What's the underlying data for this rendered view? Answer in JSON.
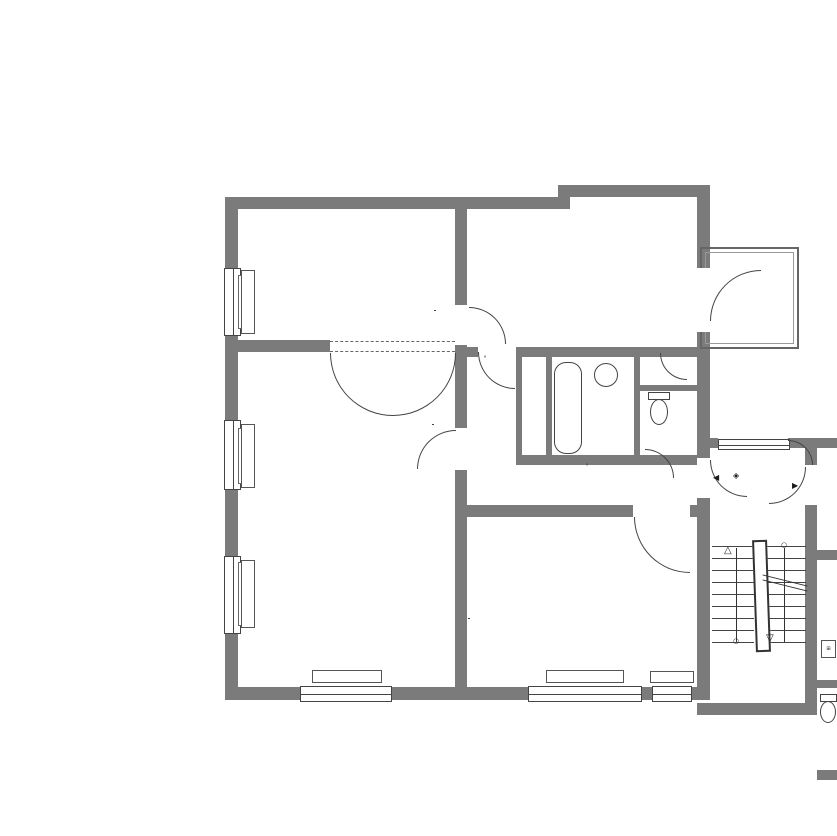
{
  "rooms": {
    "schlafen1": {
      "name": "Schlafen 1",
      "line1": "WoFl ca.: 16,82 m²",
      "line2": "LRH: 2,770 m"
    },
    "kochen": {
      "name": "Kochen",
      "line1": "WoFl ca.: 16,93 m²",
      "line2": "LRH: 2,785 m"
    },
    "balkon": {
      "name": "Balkon",
      "line1": "NRF: 4,23 m²",
      "line2": "WoFl (25%) ca.: 1,06 m²",
      "line3": "LRH: 2,800 m"
    },
    "wohnen": {
      "name": "Wohnen / Essen",
      "line1": "WoFl ca.: 33,30 m²",
      "line2": "LRH: 2,765 m"
    },
    "bad": {
      "name": "Bad",
      "line1": "WoFl ca.: 3,43 m²",
      "line2": "LRH: 2,805 m"
    },
    "ar": {
      "name": "AR",
      "line1": "WoFl ca.: 0,47 m²",
      "line2": "LRH: 2,785 m"
    },
    "wc": {
      "name": "WC",
      "line1": "WoFl ca.: 1,07 m²",
      "line2": "LRH: 2,805 m"
    },
    "flur": {
      "name": "Flur",
      "line1": "WoFl ca.: 9,28 m²",
      "line2": "LRH: 2,800 m"
    },
    "schlafen2": {
      "name": "Schlafen 2",
      "line1": "WoFl ca.: 19,20 m²",
      "line2": "LRH: 2,785 m"
    },
    "treppenhaus": {
      "name": "Treppenhaus 1.OG",
      "line1": "NRF ca.: 13,06 m²",
      "line2": "LRH: 2,855 m",
      "lrh_unten": "LRH: 2,675 m"
    }
  },
  "stairwell": {
    "we2": "WE 2",
    "we3": "WE 3",
    "level": "+3,69⁵",
    "flight_top1": "9 STG.",
    "flight_top2": "ca. 18⁵/23⁵",
    "flight_left1": "7 STG.",
    "flight_left2": "ca. 18⁵/25",
    "flight_right1": "13 STG.",
    "flight_right2": "ca. 18⁵/24³"
  },
  "labels": {
    "einbauschrank": "Einbauschrank",
    "hk": "HK",
    "brh82": "BRH 82",
    "brh89": "BRH 89",
    "brh795": "BRH 79⁵",
    "brh78": "BRH 78",
    "brh845": "BRH 84⁵"
  },
  "doors": {
    "d1w": "88⁵",
    "d1h": "2,08⁵",
    "d2w": "81",
    "d2h": "2,08",
    "d3w": "86",
    "d3h": "2,06",
    "d4w": "80⁵",
    "d4h": "2,0⁵",
    "d5w": "88⁵",
    "d5h": "2,10"
  },
  "partial_right": {
    "t1": "Fl",
    "t2": "Wo",
    "t3": "LRH",
    "t4": "LRH",
    "t5": "Ein",
    "t6": "2,0",
    "t7": "Ba",
    "t8": "WoF",
    "t9": "LRH",
    "t10": "LRH",
    "t11": "2,"
  },
  "dims": {
    "top1": [
      {
        "l": "10,63⁵",
        "v": 10.635
      }
    ],
    "top2": [
      {
        "l": "41⁵",
        "v": 0.415,
        "o": "L"
      },
      {
        "l": "4,75",
        "v": 4.75
      },
      {
        "l": "28⁵",
        "v": 0.285
      },
      {
        "l": "4,77⁵",
        "v": 4.775
      },
      {
        "l": "41",
        "v": 0.41,
        "o": "R"
      }
    ],
    "top3": [
      {
        "l": "41⁵",
        "v": 0.415,
        "o": "L"
      },
      {
        "l": "4,75",
        "v": 4.75
      },
      {
        "l": "28⁵",
        "v": 0.285
      },
      {
        "l": "1,72",
        "v": 1.72
      },
      {
        "l": "12⁵",
        "v": 0.125
      },
      {
        "l": "1,94⁵",
        "v": 1.945
      },
      {
        "l": "11⁵",
        "v": 0.115
      },
      {
        "l": "87",
        "v": 0.87
      },
      {
        "l": "41",
        "v": 0.41,
        "o": "R"
      }
    ],
    "tr0": [
      {
        "l": "",
        "v": 1
      }
    ],
    "tr1": [
      {
        "l": "2,67",
        "v": 2.67
      },
      {
        "l": "28⁵",
        "v": 0.285
      },
      {
        "l": "",
        "v": 0.9
      }
    ],
    "tr2": [
      {
        "l": "75⁵",
        "v": 0.755
      },
      {
        "l": "1,28⁵",
        "v": 1.285
      },
      {
        "l": "",
        "v": 1.8
      }
    ],
    "kw": [
      {
        "l": "1,40",
        "v": 1.4
      }
    ],
    "bw": [
      {
        "l": "1,28",
        "v": 1.28
      },
      {
        "l": "12",
        "v": 0.12
      }
    ],
    "rv1": [
      {
        "l": "12",
        "v": 0.12
      },
      {
        "l": "3,34",
        "v": 3.34
      }
    ],
    "rv2": [
      {
        "l": "12",
        "v": 0.12
      },
      {
        "l": "3,42⁵",
        "v": 3.425
      }
    ],
    "redge": [
      {
        "l": "1,37",
        "v": 1.37
      },
      {
        "l": "2,10",
        "v": 2.1
      },
      {
        "l": "1,05",
        "v": 1.05
      }
    ],
    "l1": [
      {
        "l": "13",
        "v": 0.13
      },
      {
        "l": "11,06",
        "v": 11.06
      },
      {
        "l": "10",
        "v": 0.1
      }
    ],
    "l2": [
      {
        "l": "13",
        "v": 0.13
      },
      {
        "l": "3,59",
        "v": 3.59
      },
      {
        "l": "11",
        "v": 0.11
      },
      {
        "l": "6,95",
        "v": 6.95
      },
      {
        "l": "41",
        "v": 0.41
      },
      {
        "l": "10",
        "v": 0.1
      }
    ],
    "l3": [
      {
        "l": "13",
        "v": 0.13
      },
      {
        "l": "3,60⁵",
        "v": 3.605
      },
      {
        "l": "11",
        "v": 0.11
      },
      {
        "l": "3,15⁵",
        "v": 3.155
      },
      {
        "l": "11",
        "v": 0.11
      },
      {
        "l": "3,90",
        "v": 3.9
      },
      {
        "l": "41",
        "v": 0.41
      }
    ],
    "l4": [
      {
        "l": "13",
        "v": 0.13
      },
      {
        "l": "3,60⁵",
        "v": 3.605
      },
      {
        "l": "11⁵",
        "v": 0.115
      },
      {
        "l": "1,79",
        "v": 1.79
      },
      {
        "l": "12",
        "v": 0.12
      },
      {
        "l": "1,24",
        "v": 1.24
      },
      {
        "l": "11",
        "v": 0.11
      },
      {
        "l": "3,90",
        "v": 3.9
      },
      {
        "l": "41",
        "v": 0.41
      }
    ],
    "l5": [
      {
        "l": "13",
        "v": 0.13
      },
      {
        "l": "3,60⁵",
        "v": 3.605
      },
      {
        "l": "11⁵",
        "v": 0.115
      },
      {
        "l": "52⁵",
        "v": 0.525
      },
      {
        "l": "7",
        "v": 0.07
      },
      {
        "l": "1,24⁵",
        "v": 1.245
      },
      {
        "l": "12",
        "v": 0.12
      },
      {
        "l": "10",
        "v": 0.1
      },
      {
        "l": "1,21",
        "v": 1.21
      },
      {
        "l": "11",
        "v": 0.11
      },
      {
        "l": "3,90",
        "v": 3.9
      },
      {
        "l": "41",
        "v": 0.41
      }
    ],
    "l6": [
      {
        "l": "13",
        "v": 0.13
      },
      {
        "l": "1,59⁵",
        "v": 1.595
      },
      {
        "l": "1,58⁵",
        "v": 1.585,
        "l2": "1,30⁵"
      },
      {
        "l": "1,62",
        "v": 1.62
      },
      {
        "l": "1,58",
        "v": 1.58,
        "l2": "1,32"
      },
      {
        "l": "1,59⁵",
        "v": 1.595
      },
      {
        "l": "1,57⁵",
        "v": 1.575,
        "l2": "1,31⁵"
      },
      {
        "l": "1,51",
        "v": 1.51
      },
      {
        "l": "10",
        "v": 0.1
      }
    ],
    "ba": [
      {
        "l": "1,80",
        "v": 1.8
      },
      {
        "l": "1,59⁵",
        "v": 1.595,
        "l2": "1,30"
      },
      {
        "l": "1,77",
        "v": 1.77
      },
      {
        "l": "1,63",
        "v": 1.63
      },
      {
        "l": "1,58⁵",
        "v": 1.585,
        "l2": "1,30⁵"
      },
      {
        "l": "84⁵",
        "v": 0.845
      },
      {
        "l": "72",
        "v": 0.72,
        "l2": "1,30⁵"
      },
      {
        "l": "29⁵",
        "v": 0.295,
        "o": "R"
      }
    ],
    "bb": [
      {
        "l": "41⁵",
        "v": 0.415,
        "o": "L"
      },
      {
        "l": "4,75",
        "v": 4.75
      },
      {
        "l": "28",
        "v": 0.28
      },
      {
        "l": "4,91",
        "v": 4.91
      },
      {
        "l": "28",
        "v": 0.28
      }
    ],
    "bc": [
      {
        "l": "10,24",
        "v": 10.24
      },
      {
        "l": "39⁵",
        "v": 0.395
      }
    ],
    "br1": [
      {
        "l": "3,03",
        "v": 3.03
      },
      {
        "l": "45⁵",
        "v": 0.455,
        "l2": "90¹"
      }
    ],
    "br2": [
      {
        "l": "36⁵",
        "v": 0.365,
        "o": "L"
      },
      {
        "l": "2,25⁵",
        "v": 2.255
      },
      {
        "l": "30⁵",
        "v": 0.305
      },
      {
        "l": "1,25",
        "v": 1.25
      }
    ]
  }
}
